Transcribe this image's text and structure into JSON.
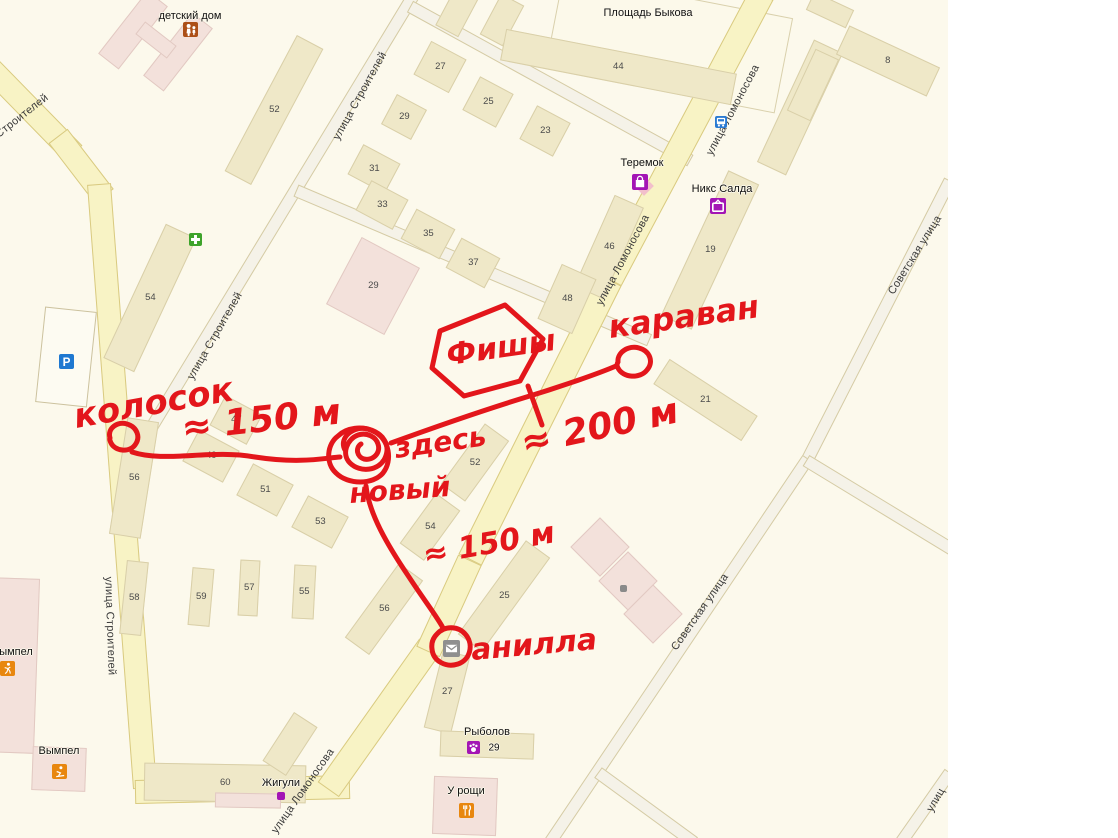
{
  "colors": {
    "background": "#FCF9EC",
    "road_yellow": "#F8F3C5",
    "road_minor": "#F5F2E8",
    "building_beige": "#EFE8C8",
    "building_pink": "#F3E1DB",
    "annotation_red": "#E3161B",
    "poi_purple": "#A315B5",
    "poi_orange": "#E8870F",
    "poi_blue": "#2A7AD2",
    "poi_green": "#3EA32B",
    "poi_gray": "#8F8F8F",
    "poi_brown": "#AC4F17"
  },
  "map": {
    "street_labels": [
      {
        "text": "Строителей",
        "x": 22,
        "y": 116,
        "rot": -38
      },
      {
        "text": "улица Строителей",
        "x": 360,
        "y": 96,
        "rot": -61
      },
      {
        "text": "улица Строителей",
        "x": 215,
        "y": 336,
        "rot": -60
      },
      {
        "text": "улица Строителей",
        "x": 110,
        "y": 626,
        "rot": 88
      },
      {
        "text": "улица Ломоносова",
        "x": 733,
        "y": 110,
        "rot": -62
      },
      {
        "text": "улица Ломоносова",
        "x": 623,
        "y": 260,
        "rot": -62
      },
      {
        "text": "улица Ломоносова",
        "x": 303,
        "y": 791,
        "rot": -55
      },
      {
        "text": "Советская улица",
        "x": 915,
        "y": 255,
        "rot": -58
      },
      {
        "text": "Советская улица",
        "x": 700,
        "y": 612,
        "rot": -55
      },
      {
        "text": "улиц",
        "x": 936,
        "y": 800,
        "rot": -60
      }
    ],
    "place_labels": [
      {
        "text": "детский дом",
        "x": 190,
        "y": 16
      },
      {
        "text": "Площадь Быкова",
        "x": 648,
        "y": 13
      },
      {
        "text": "Теремок",
        "x": 642,
        "y": 163
      },
      {
        "text": "Никс Салда",
        "x": 722,
        "y": 189
      },
      {
        "text": "Рыболов",
        "x": 487,
        "y": 732
      },
      {
        "text": "29",
        "x": 494,
        "y": 748,
        "size": 10
      },
      {
        "text": "У рощи",
        "x": 466,
        "y": 791
      },
      {
        "text": "Жигули",
        "x": 281,
        "y": 783
      },
      {
        "text": "Вымпел",
        "x": 59,
        "y": 751
      },
      {
        "text": "ымпел",
        "x": 16,
        "y": 652
      }
    ],
    "buildings": [
      {
        "cx": 133,
        "cy": 30,
        "w": 26,
        "h": 80,
        "rot": 38,
        "c": "p",
        "n": ""
      },
      {
        "cx": 178,
        "cy": 52,
        "w": 26,
        "h": 80,
        "rot": 38,
        "c": "p",
        "n": ""
      },
      {
        "cx": 156,
        "cy": 40,
        "w": 40,
        "h": 16,
        "rot": 38,
        "c": "p",
        "n": ""
      },
      {
        "cx": 274,
        "cy": 110,
        "w": 30,
        "h": 154,
        "rot": 28,
        "c": "b",
        "n": "52"
      },
      {
        "cx": 458,
        "cy": 10,
        "w": 26,
        "h": 48,
        "rot": 28,
        "c": "b",
        "n": ""
      },
      {
        "cx": 502,
        "cy": 20,
        "w": 26,
        "h": 46,
        "rot": 28,
        "c": "b",
        "n": ""
      },
      {
        "cx": 440,
        "cy": 67,
        "w": 40,
        "h": 38,
        "rot": 28,
        "c": "b",
        "n": "27"
      },
      {
        "cx": 488,
        "cy": 102,
        "w": 38,
        "h": 38,
        "rot": 28,
        "c": "b",
        "n": "25"
      },
      {
        "cx": 404,
        "cy": 117,
        "w": 34,
        "h": 34,
        "rot": 28,
        "c": "b",
        "n": "29"
      },
      {
        "cx": 545,
        "cy": 131,
        "w": 38,
        "h": 38,
        "rot": 28,
        "c": "b",
        "n": "23"
      },
      {
        "cx": 618,
        "cy": 67,
        "w": 235,
        "h": 32,
        "rot": 11,
        "c": "b",
        "n": "44"
      },
      {
        "cx": 374,
        "cy": 169,
        "w": 42,
        "h": 34,
        "rot": 28,
        "c": "b",
        "n": "31"
      },
      {
        "cx": 382,
        "cy": 205,
        "w": 42,
        "h": 34,
        "rot": 28,
        "c": "b",
        "n": "33"
      },
      {
        "cx": 428,
        "cy": 234,
        "w": 44,
        "h": 34,
        "rot": 28,
        "c": "b",
        "n": "35"
      },
      {
        "cx": 473,
        "cy": 263,
        "w": 44,
        "h": 34,
        "rot": 28,
        "c": "b",
        "n": "37"
      },
      {
        "cx": 373,
        "cy": 286,
        "w": 66,
        "h": 76,
        "rot": 28,
        "c": "p",
        "n": "29"
      },
      {
        "cx": 609,
        "cy": 247,
        "w": 32,
        "h": 100,
        "rot": 24,
        "c": "b",
        "n": "46"
      },
      {
        "cx": 567,
        "cy": 299,
        "w": 38,
        "h": 60,
        "rot": 24,
        "c": "b",
        "n": "48"
      },
      {
        "cx": 800,
        "cy": 107,
        "w": 32,
        "h": 135,
        "rot": 25,
        "c": "b",
        "n": "17"
      },
      {
        "cx": 710,
        "cy": 250,
        "w": 34,
        "h": 160,
        "rot": 25,
        "c": "b",
        "n": "19"
      },
      {
        "cx": 888,
        "cy": 61,
        "w": 100,
        "h": 32,
        "rot": 25,
        "c": "b",
        "n": "8"
      },
      {
        "cx": 830,
        "cy": 10,
        "w": 44,
        "h": 20,
        "rot": 25,
        "c": "b",
        "n": ""
      },
      {
        "cx": 813,
        "cy": 85,
        "w": 26,
        "h": 68,
        "rot": 25,
        "c": "b",
        "n": ""
      },
      {
        "cx": 705,
        "cy": 400,
        "w": 105,
        "h": 30,
        "rot": 33,
        "c": "b",
        "n": "21"
      },
      {
        "cx": 150,
        "cy": 298,
        "w": 34,
        "h": 148,
        "rot": 25,
        "c": "b",
        "n": "54"
      },
      {
        "cx": 134,
        "cy": 478,
        "w": 32,
        "h": 118,
        "rot": 9,
        "c": "b",
        "n": "56"
      },
      {
        "cx": 236,
        "cy": 420,
        "w": 42,
        "h": 34,
        "rot": 28,
        "c": "b",
        "n": "47"
      },
      {
        "cx": 211,
        "cy": 456,
        "w": 46,
        "h": 36,
        "rot": 28,
        "c": "b",
        "n": "49"
      },
      {
        "cx": 265,
        "cy": 490,
        "w": 46,
        "h": 36,
        "rot": 28,
        "c": "b",
        "n": "51"
      },
      {
        "cx": 320,
        "cy": 522,
        "w": 46,
        "h": 36,
        "rot": 28,
        "c": "b",
        "n": "53"
      },
      {
        "cx": 475,
        "cy": 462,
        "w": 30,
        "h": 75,
        "rot": 36,
        "c": "b",
        "n": "52"
      },
      {
        "cx": 430,
        "cy": 527,
        "w": 30,
        "h": 62,
        "rot": 36,
        "c": "b",
        "n": "54"
      },
      {
        "cx": 504,
        "cy": 596,
        "w": 30,
        "h": 116,
        "rot": 36,
        "c": "b",
        "n": "25"
      },
      {
        "cx": 384,
        "cy": 609,
        "w": 30,
        "h": 92,
        "rot": 36,
        "c": "b",
        "n": "56"
      },
      {
        "cx": 447,
        "cy": 692,
        "w": 28,
        "h": 80,
        "rot": 14,
        "c": "b",
        "n": "27"
      },
      {
        "cx": 487,
        "cy": 745,
        "w": 94,
        "h": 26,
        "rot": 2,
        "c": "b",
        "n": ""
      },
      {
        "cx": 465,
        "cy": 806,
        "w": 64,
        "h": 58,
        "rot": 2,
        "c": "p",
        "n": ""
      },
      {
        "cx": 134,
        "cy": 598,
        "w": 22,
        "h": 74,
        "rot": 6,
        "c": "b",
        "n": "58"
      },
      {
        "cx": 201,
        "cy": 597,
        "w": 22,
        "h": 58,
        "rot": 5,
        "c": "b",
        "n": "59"
      },
      {
        "cx": 249,
        "cy": 588,
        "w": 20,
        "h": 56,
        "rot": 3,
        "c": "b",
        "n": "57"
      },
      {
        "cx": 304,
        "cy": 592,
        "w": 22,
        "h": 54,
        "rot": 3,
        "c": "b",
        "n": "55"
      },
      {
        "cx": 225,
        "cy": 783,
        "w": 162,
        "h": 38,
        "rot": 1,
        "c": "b",
        "n": "60"
      },
      {
        "cx": 290,
        "cy": 744,
        "w": 28,
        "h": 58,
        "rot": 33,
        "c": "b",
        "n": ""
      },
      {
        "cx": 248,
        "cy": 800,
        "w": 66,
        "h": 15,
        "rot": 1,
        "c": "p",
        "n": ""
      },
      {
        "cx": 12,
        "cy": 665,
        "w": 50,
        "h": 175,
        "rot": 2,
        "c": "p",
        "n": ""
      },
      {
        "cx": 59,
        "cy": 769,
        "w": 54,
        "h": 44,
        "rot": 2,
        "c": "p",
        "n": ""
      },
      {
        "cx": 600,
        "cy": 547,
        "w": 42,
        "h": 42,
        "rot": 45,
        "c": "p",
        "n": ""
      },
      {
        "cx": 628,
        "cy": 581,
        "w": 42,
        "h": 42,
        "rot": 45,
        "c": "p",
        "n": ""
      },
      {
        "cx": 653,
        "cy": 614,
        "w": 42,
        "h": 42,
        "rot": 45,
        "c": "p",
        "n": ""
      },
      {
        "cx": 66,
        "cy": 357,
        "w": 52,
        "h": 96,
        "rot": 6,
        "c": "w",
        "n": ""
      }
    ],
    "icons": [
      {
        "name": "diamond",
        "x": 644,
        "y": 186,
        "s": 14,
        "bg": "#F2BFCB"
      },
      {
        "name": "family",
        "x": 190,
        "y": 29,
        "s": 15,
        "bg": "#AC4F17"
      },
      {
        "name": "plus",
        "x": 195,
        "y": 239,
        "s": 13,
        "bg": "#3EA32B"
      },
      {
        "name": "parking",
        "x": 66,
        "y": 361,
        "s": 15,
        "bg": "#1F78D1"
      },
      {
        "name": "bus",
        "x": 721,
        "y": 122,
        "s": 12,
        "bg": "#2A7AD2"
      },
      {
        "name": "bag",
        "x": 640,
        "y": 182,
        "s": 16,
        "bg": "#A315B5"
      },
      {
        "name": "tv",
        "x": 718,
        "y": 206,
        "s": 16,
        "bg": "#A315B5"
      },
      {
        "name": "mail",
        "x": 451,
        "y": 648,
        "s": 17,
        "bg": "#8F8F8F"
      },
      {
        "name": "paw",
        "x": 473,
        "y": 747,
        "s": 13,
        "bg": "#A315B5"
      },
      {
        "name": "dot",
        "x": 281,
        "y": 796,
        "s": 8,
        "bg": "#A315B5"
      },
      {
        "name": "restaurant",
        "x": 466,
        "y": 810,
        "s": 15,
        "bg": "#E8870F"
      },
      {
        "name": "skier",
        "x": 59,
        "y": 771,
        "s": 15,
        "bg": "#E8870F"
      },
      {
        "name": "runner",
        "x": 7,
        "y": 668,
        "s": 15,
        "bg": "#E8870F"
      },
      {
        "name": "dot",
        "x": 623,
        "y": 588,
        "s": 7,
        "bg": "#8A8A8A"
      }
    ]
  },
  "annotations": {
    "color": "#E3161B",
    "texts": [
      {
        "text": "колосок",
        "x": 76,
        "y": 428,
        "rot": -10,
        "size": 34
      },
      {
        "text": "≈ 150 м",
        "x": 183,
        "y": 440,
        "rot": -6,
        "size": 36
      },
      {
        "text": "Фишы",
        "x": 448,
        "y": 365,
        "rot": -8,
        "size": 30
      },
      {
        "text": "караван",
        "x": 610,
        "y": 338,
        "rot": -8,
        "size": 32
      },
      {
        "text": "≈ 200 м",
        "x": 524,
        "y": 455,
        "rot": -12,
        "size": 36
      },
      {
        "text": "здесь",
        "x": 396,
        "y": 458,
        "rot": -8,
        "size": 28
      },
      {
        "text": "новый",
        "x": 350,
        "y": 503,
        "rot": -4,
        "size": 28
      },
      {
        "text": "≈ 150 м",
        "x": 425,
        "y": 565,
        "rot": -10,
        "size": 30
      },
      {
        "text": "анилла",
        "x": 472,
        "y": 660,
        "rot": -5,
        "size": 30
      }
    ]
  }
}
